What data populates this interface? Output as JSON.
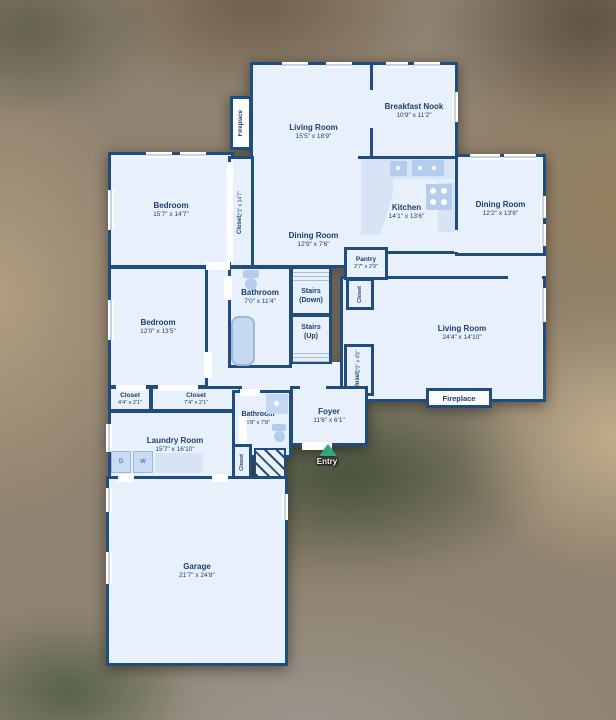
{
  "floorplan": {
    "colors": {
      "wall": "#204d7d",
      "room_fill": "#e8f0fb",
      "fixture_fill": "#c5d8f1",
      "label_text": "#1c3f6e",
      "entry_arrow": "#2fa87e"
    },
    "rooms": {
      "living_top": {
        "name": "Living Room",
        "dims": "15'5\" x 18'9\""
      },
      "dining_center": {
        "name": "Dining Room",
        "dims": "12'9\" x 7'6\""
      },
      "breakfast_nook": {
        "name": "Breakfast Nook",
        "dims": "10'9\" x 11'2\""
      },
      "kitchen": {
        "name": "Kitchen",
        "dims": "14'1\" x 13'6\""
      },
      "dining_right": {
        "name": "Dining Room",
        "dims": "12'2\" x 13'6\""
      },
      "bedroom_top": {
        "name": "Bedroom",
        "dims": "15'7\" x 14'7\""
      },
      "closet_hall": {
        "name": "Closet",
        "dims": "2'1\" x 14'7\""
      },
      "pantry": {
        "name": "Pantry",
        "dims": "2'7\" x 2'9\""
      },
      "closet_pantry": {
        "name": "Closet"
      },
      "bathroom_main": {
        "name": "Bathroom",
        "dims": "7'0\" x 11'4\""
      },
      "stairs_down": {
        "name": "Stairs",
        "sub": "(Down)"
      },
      "stairs_up": {
        "name": "Stairs",
        "sub": "(Up)"
      },
      "bedroom_2": {
        "name": "Bedroom",
        "dims": "12'0\" x 13'5\""
      },
      "living_right": {
        "name": "Living Room",
        "dims": "24'4\" x 14'10\""
      },
      "closet_foyer": {
        "name": "Closet",
        "dims": "2'0\" x 4'8\""
      },
      "closet_left": {
        "name": "Closet",
        "dims": "4'4\" x 2'1\""
      },
      "closet_mid": {
        "name": "Closet",
        "dims": "7'4\" x 2'1\""
      },
      "laundry": {
        "name": "Laundry Room",
        "dims": "15'7\" x 16'10\""
      },
      "bathroom_2": {
        "name": "Bathroom",
        "dims": "5'8\" x 7'8\""
      },
      "foyer": {
        "name": "Foyer",
        "dims": "11'6\" x 6'1\""
      },
      "closet_laundry": {
        "name": "Closet"
      },
      "garage": {
        "name": "Garage",
        "dims": "21'7\" x 24'8\""
      }
    },
    "features": {
      "fireplace_top": "Fireplace",
      "fireplace_bottom": "Fireplace",
      "entry": "Entry",
      "washer": "W",
      "dryer": "D"
    }
  }
}
